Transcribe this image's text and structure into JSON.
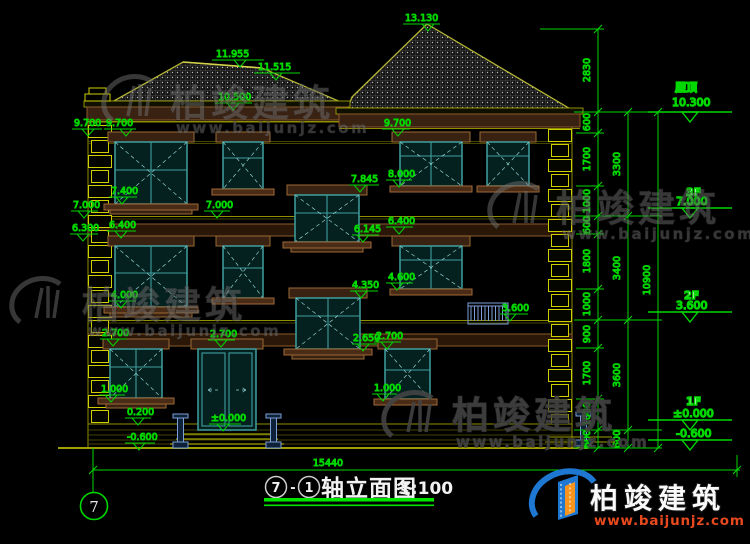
{
  "drawing": {
    "title": {
      "axis_start": "7",
      "separator": "-",
      "axis_end": "1",
      "name": "轴立面图",
      "scale": "1:100"
    },
    "axis_bubble": "7",
    "overall_dim": "15440"
  },
  "floor_markers": {
    "roof": {
      "label": "屋顶",
      "elev": "10.300"
    },
    "f3": {
      "label": "3F",
      "elev": "7.000"
    },
    "f2": {
      "label": "2F",
      "elev": "3.600"
    },
    "f1": {
      "label": "1F",
      "elev": "±0.000"
    },
    "ground": {
      "elev": "-0.600"
    }
  },
  "levels": {
    "ridge_main": "13.130",
    "ridge_left": "11.955",
    "ridge_left_end": "11.515",
    "eave_left": "10.500",
    "head_3f_a": "9.700",
    "head_3f_b": "9.700",
    "head_3f_c": "9.700",
    "sill_3f_c": "8.000",
    "head_stair_up": "7.845",
    "sill_3f_a": "7.400",
    "floor_3f_a": "7.000",
    "floor_3f_b": "7.000",
    "head_2f_a": "6.300",
    "head_2f_b": "6.400",
    "head_2f_c": "6.400",
    "sill_stair_up": "6.145",
    "sill_2f_c": "4.600",
    "head_stair_low": "4.350",
    "sill_2f_a": "4.000",
    "railing_2f": "3.600",
    "head_1f_a": "2.700",
    "head_1f_b": "2.700",
    "sill_stair_low": "2.650",
    "head_1f_c": "2.700",
    "sill_1f_a": "1.000",
    "sill_1f_c": "1.000",
    "plinth": "0.200",
    "entry": "±0.000",
    "ground_left": "-0.600"
  },
  "dim_chains": {
    "inner": [
      "2830",
      "600",
      "1700",
      "1000",
      "600",
      "1800",
      "1000",
      "900",
      "1700",
      "1000",
      "600"
    ],
    "middle": [
      "3300",
      "3400",
      "3600",
      "600"
    ],
    "outer": "10900"
  },
  "watermark": {
    "brand": "柏竣建筑",
    "url": "www.baijunjz.com"
  },
  "logo": {
    "brand": "柏竣建筑",
    "url": "www.baijunjz.com"
  },
  "colors": {
    "background": "#000000",
    "dim_green": "#00d800",
    "wall_olive": "#767600",
    "quoin_yellow": "#cfcf00",
    "trim_brown": "#8a5a2b",
    "window_teal": "#3f9f9f",
    "logo_blue": "#1e78d2",
    "logo_orange": "#f7941d"
  }
}
